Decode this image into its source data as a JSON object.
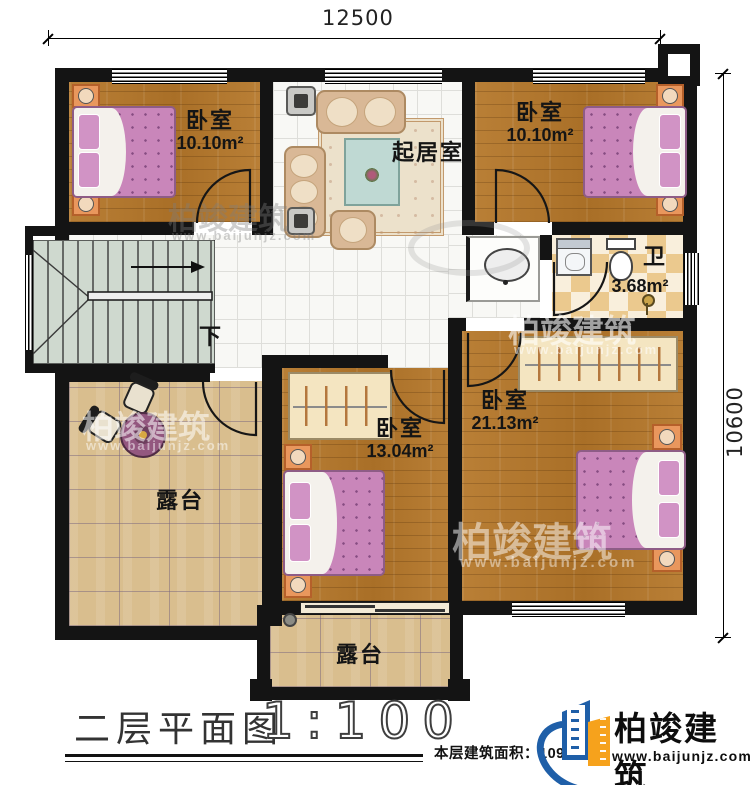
{
  "dimensions": {
    "top": "12500",
    "right": "10600"
  },
  "title": {
    "name": "二层平面图",
    "scale": "1:100"
  },
  "footer": {
    "area_text": "本层建筑面积：109."
  },
  "brand": {
    "name": "柏竣建筑",
    "url": "www.baijunjz.com"
  },
  "rooms": [
    {
      "name": "卧室",
      "area": "10.10m²"
    },
    {
      "name": "起居室",
      "area": ""
    },
    {
      "name": "卧室",
      "area": "10.10m²"
    },
    {
      "name": "卫",
      "area": "3.68m²"
    },
    {
      "name": "卧室",
      "area": "21.13m²"
    },
    {
      "name": "卧室",
      "area": "13.04m²"
    },
    {
      "name": "露台"
    },
    {
      "name": "露台"
    },
    {
      "name": "下"
    }
  ],
  "colors": {
    "wall": "#141414",
    "wood_floor": "#b1762c",
    "tile_floor": "#f8f8f5",
    "bath_checker": "#ebc98e",
    "terrace_tile": "#d9be8e",
    "bed_pink": "#c986ba",
    "nightstand_orange": "#e9975d",
    "brand_blue": "#1f5fa8",
    "brand_orange": "#f6a21c"
  }
}
